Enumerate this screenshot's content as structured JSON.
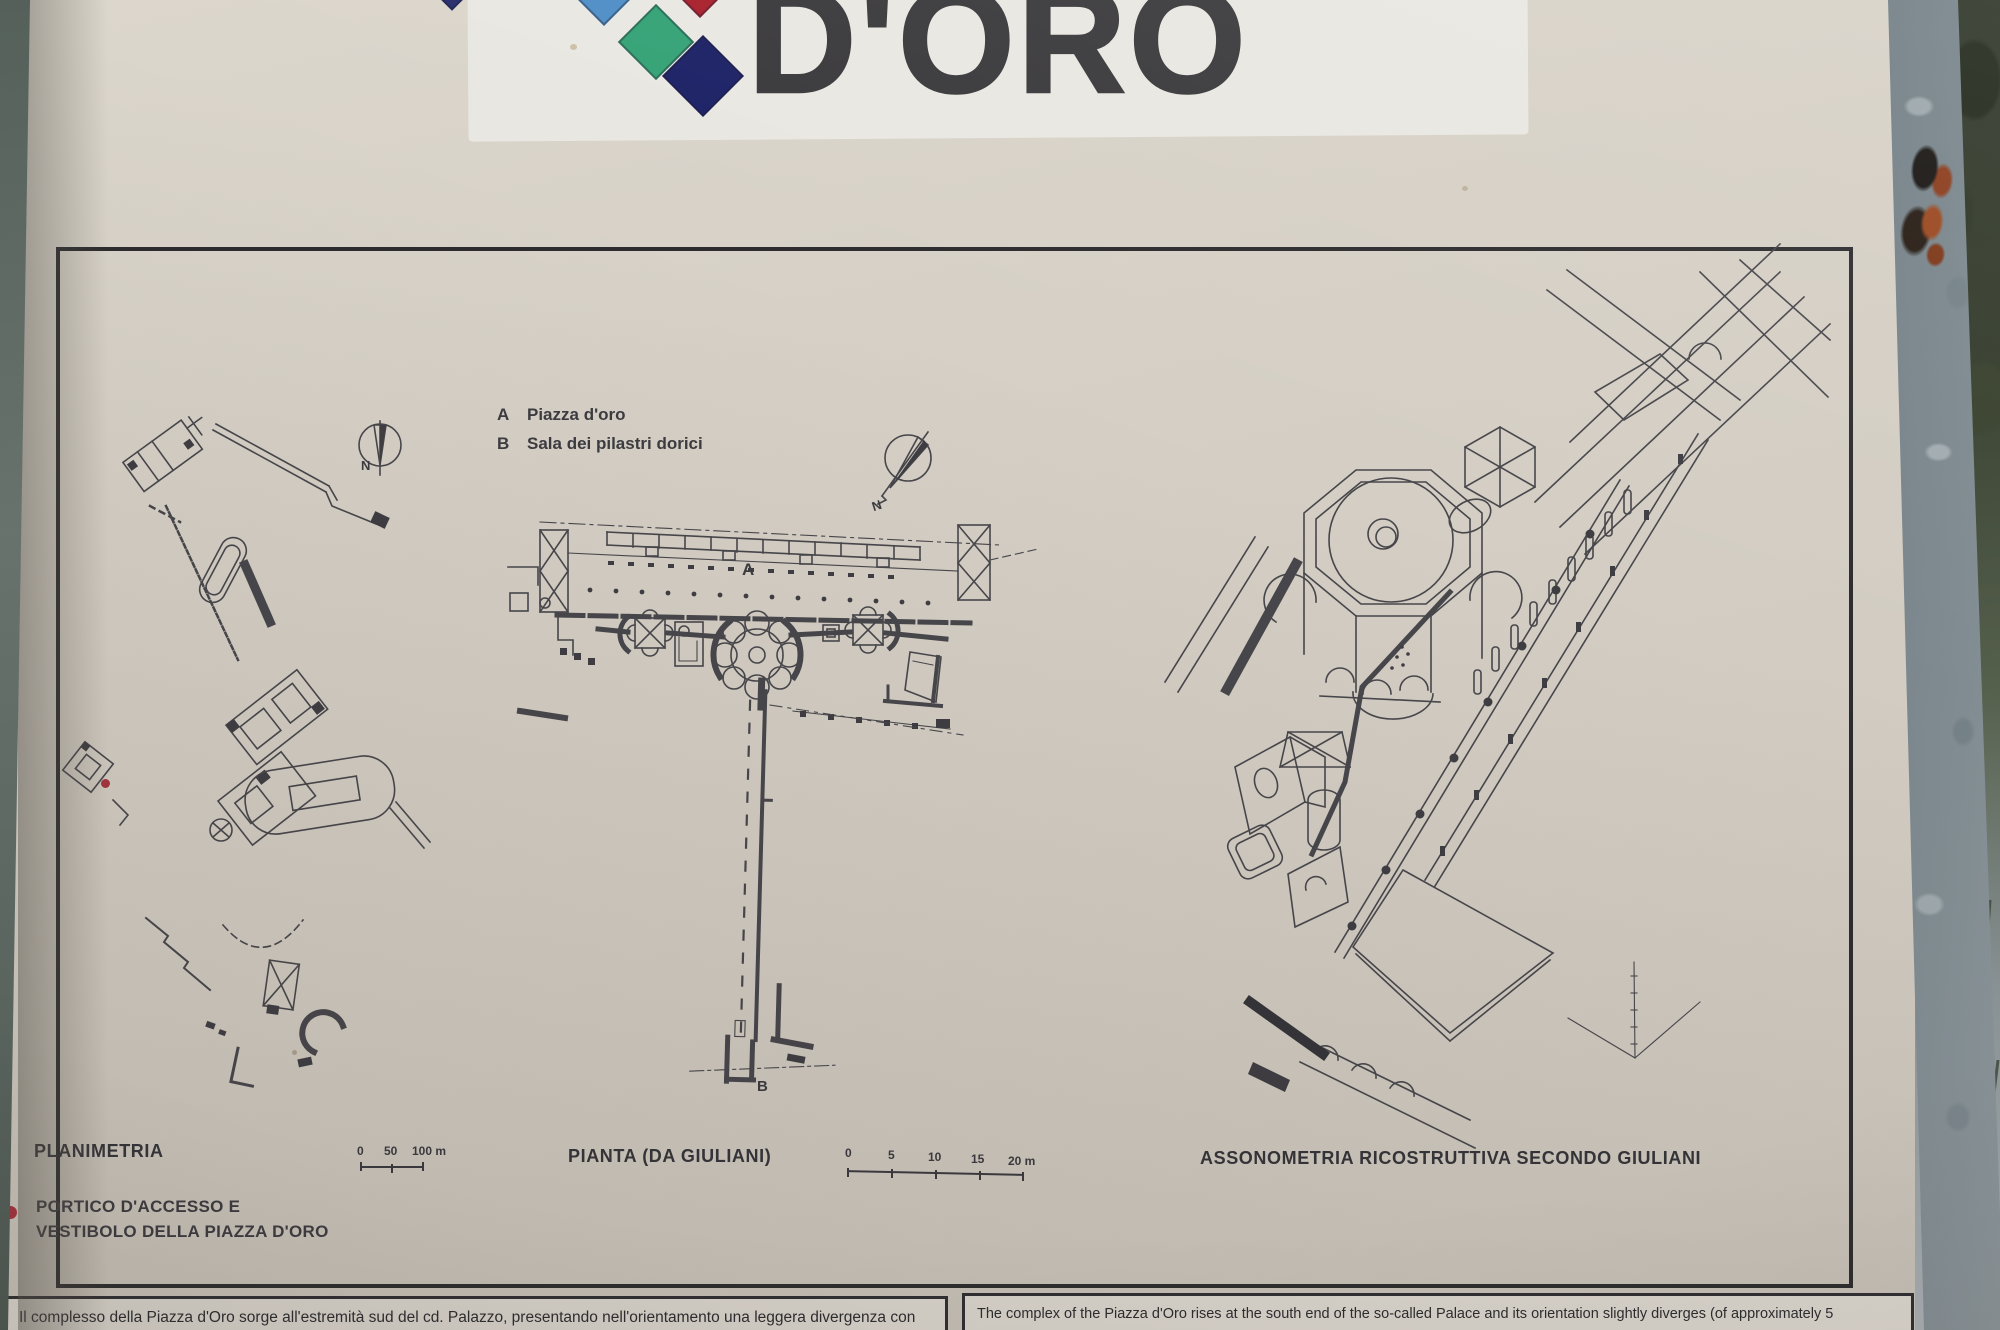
{
  "header": {
    "title": "D'ORO"
  },
  "legend": {
    "items": [
      {
        "key": "A",
        "label": "Piazza d'oro"
      },
      {
        "key": "B",
        "label": "Sala dei pilastri dorici"
      }
    ]
  },
  "plan_labels": {
    "a": "A",
    "b": "B"
  },
  "north": {
    "label": "N"
  },
  "sections": {
    "planimetria": {
      "title": "PLANIMETRIA",
      "scale_ticks": [
        "0",
        "50",
        "100 m"
      ]
    },
    "pianta": {
      "title": "PIANTA (DA GIULIANI)",
      "scale_ticks": [
        "0",
        "5",
        "10",
        "15",
        "20 m"
      ]
    },
    "assonometria": {
      "title": "ASSONOMETRIA RICOSTRUTTIVA SECONDO GIULIANI"
    }
  },
  "callout": {
    "line1": "PORTICO D'ACCESSO E",
    "line2": "VESTIBOLO DELLA PIAZZA D'ORO"
  },
  "footer": {
    "italian": "Il complesso della Piazza d'Oro sorge all'estremità sud del cd. Palazzo, presentando nell'orientamento una leggera divergenza con",
    "english": "The complex of the Piazza d'Oro rises at the south end of the so-called Palace and its orientation slightly diverges (of approximately 5"
  },
  "colors": {
    "logo_light_blue": "#4e8ec6",
    "logo_red": "#a81f2b",
    "logo_green": "#35a276",
    "logo_navy": "#1c2166",
    "logo_indigo": "#272e6d",
    "marker_red": "#a8333e",
    "ink": "#47464b",
    "panel_cream": "#d5cfc5",
    "title_gray": "#39383b"
  }
}
